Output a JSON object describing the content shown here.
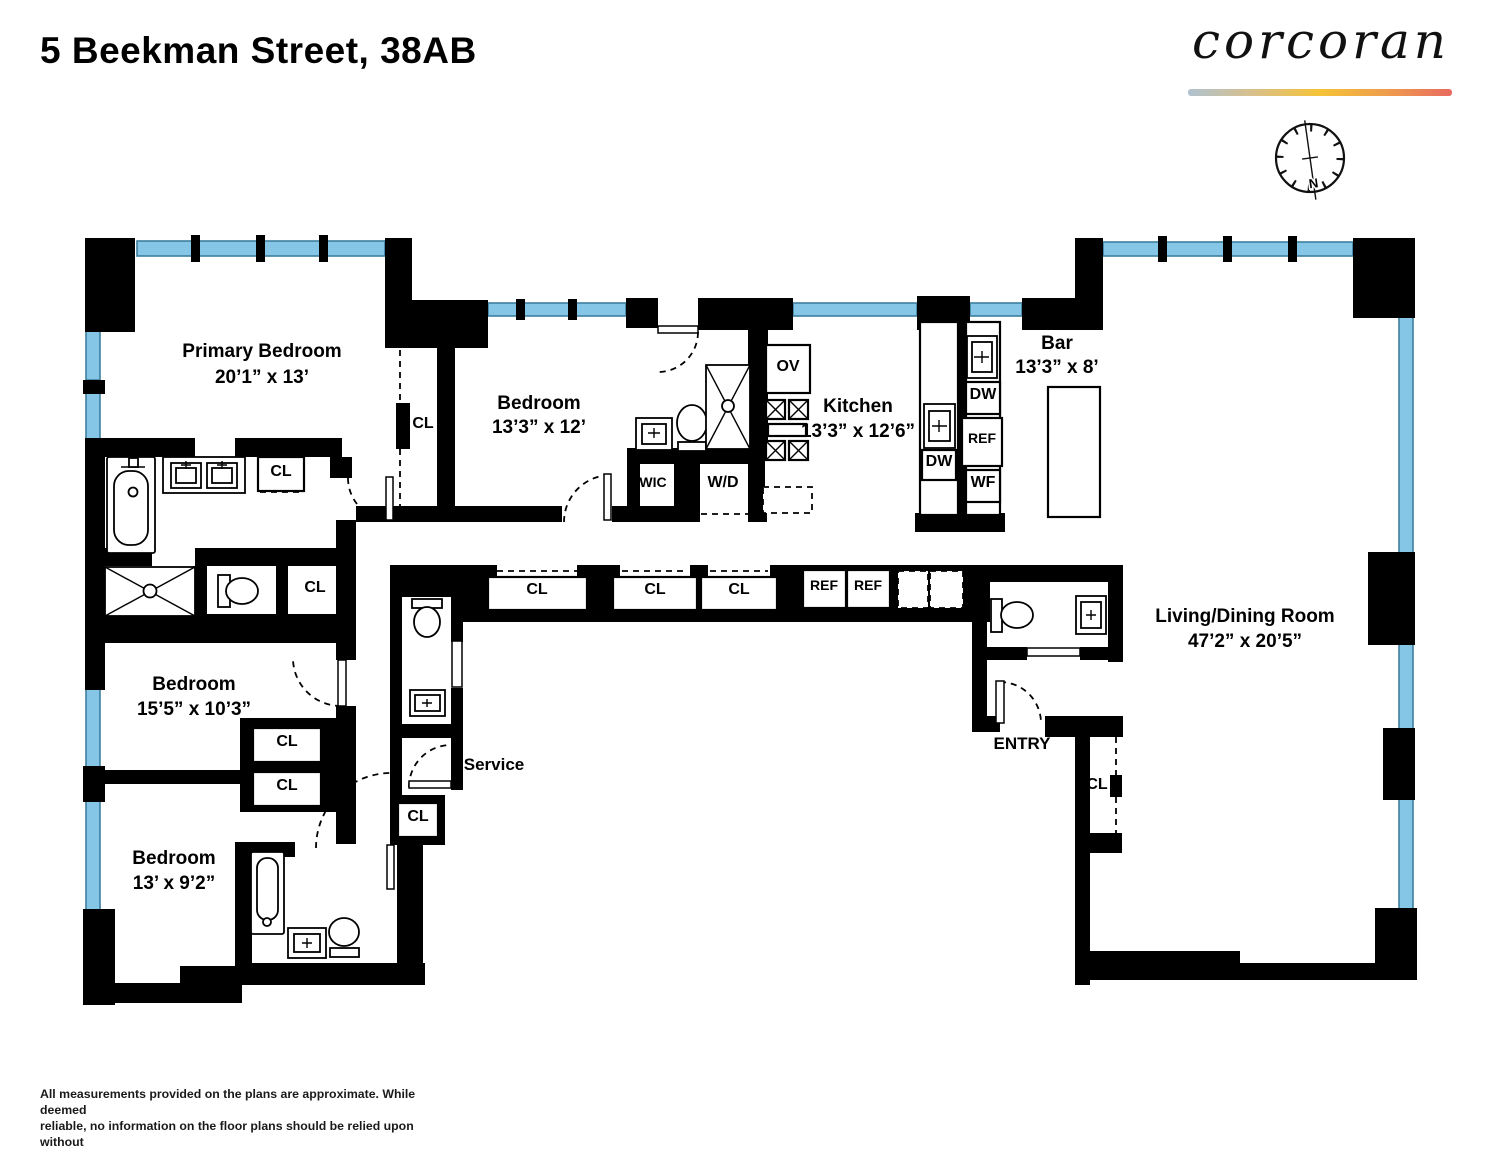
{
  "header": {
    "title": "5 Beekman Street, 38AB",
    "brand": "corcoran"
  },
  "compass": {
    "north": "N"
  },
  "rooms": {
    "primary": {
      "name": "Primary Bedroom",
      "dims": "20’1” x 13’"
    },
    "bedroom2": {
      "name": "Bedroom",
      "dims": "13’3” x 12’"
    },
    "kitchen": {
      "name": "Kitchen",
      "dims": "13’3” x 12’6”"
    },
    "bar": {
      "name": "Bar",
      "dims": "13’3” x 8’"
    },
    "living": {
      "name": "Living/Dining Room",
      "dims": "47’2” x 20’5”"
    },
    "bedroom3": {
      "name": "Bedroom",
      "dims": "15’5” x 10’3”"
    },
    "bedroom4": {
      "name": "Bedroom",
      "dims": "13’ x 9’2”"
    },
    "service": {
      "name": "Service"
    },
    "entry": {
      "name": "ENTRY"
    }
  },
  "labels": {
    "closet": "CL",
    "walk_in_closet": "WIC",
    "washer_dryer": "W/D",
    "oven": "OV",
    "dishwasher": "DW",
    "refrigerator": "REF",
    "wine_fridge": "WF"
  },
  "disclaimer": {
    "lines": [
      "All measurements provided on the plans are approximate. While deemed",
      "reliable, no information on the floor plans should be relied upon without",
      "independent verification."
    ]
  },
  "colors": {
    "wall": "#000000",
    "window": "#85C6E6",
    "window_stroke": "#3E7E9F",
    "gradient": [
      "#AFC2CF",
      "#D9C089",
      "#F5C337",
      "#EE9D4D",
      "#E96A60"
    ]
  }
}
